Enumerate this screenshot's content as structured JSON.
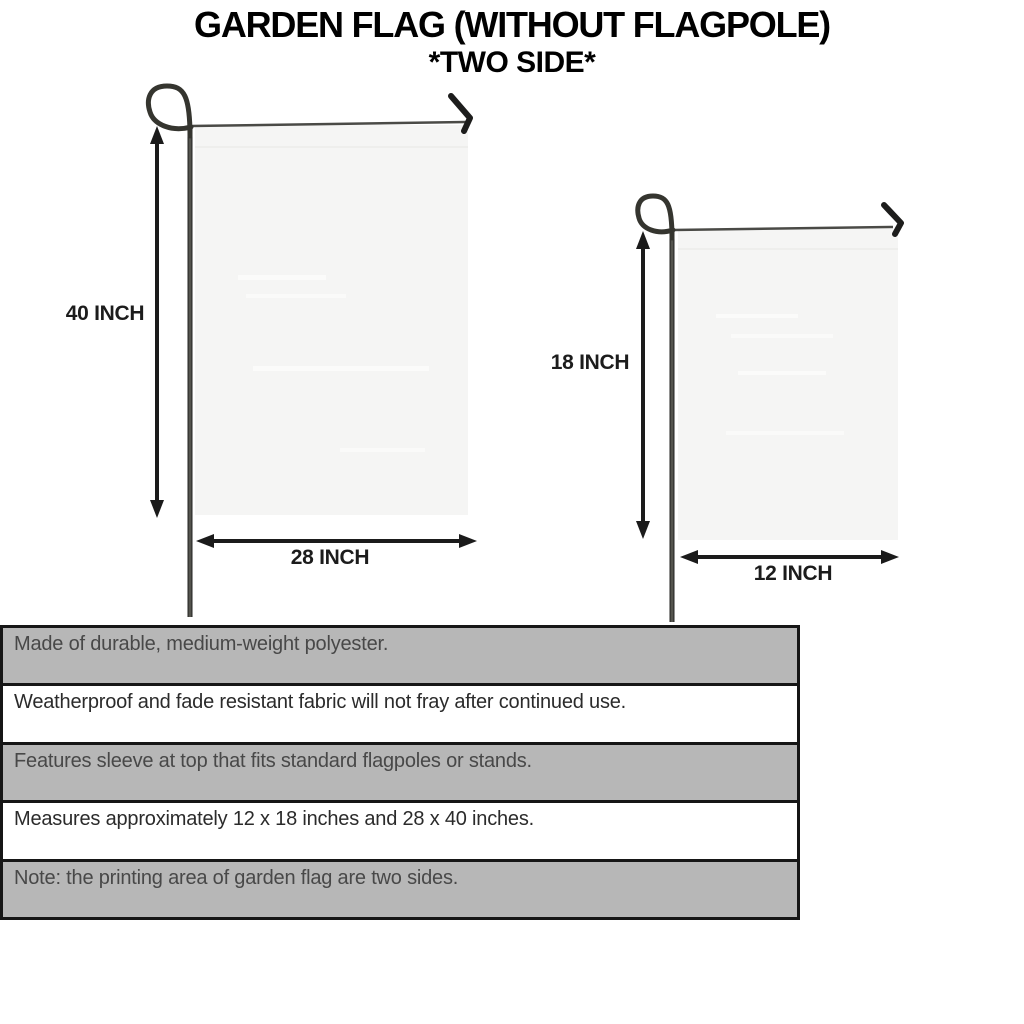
{
  "title": {
    "line1": "GARDEN FLAG (WITHOUT FLAGPOLE)",
    "line2": "*TWO SIDE*"
  },
  "diagram": {
    "large_flag": {
      "height_label": "40 INCH",
      "width_label": "28 INCH"
    },
    "small_flag": {
      "height_label": "18 INCH",
      "width_label": "12 INCH"
    }
  },
  "features": {
    "rows": [
      {
        "text": "Made of durable, medium-weight polyester.",
        "shade": "gray"
      },
      {
        "text": "Weatherproof and fade resistant fabric will not fray after continued use.",
        "shade": "white"
      },
      {
        "text": "Features sleeve at top that fits standard flagpoles or stands.",
        "shade": "gray"
      },
      {
        "text": "Measures approximately 12 x 18 inches and 28 x 40 inches.",
        "shade": "white"
      },
      {
        "text": "Note: the printing area of garden flag are two sides.",
        "shade": "gray"
      }
    ]
  },
  "colors": {
    "row_gray": "#b7b7b7",
    "table_border": "#161616",
    "flag_fill": "#f5f5f4",
    "pole_dark": "#2e2e2b",
    "arrow": "#1b1b1b",
    "title_text": "#000000",
    "dim_label_text": "#1c1c1c"
  }
}
